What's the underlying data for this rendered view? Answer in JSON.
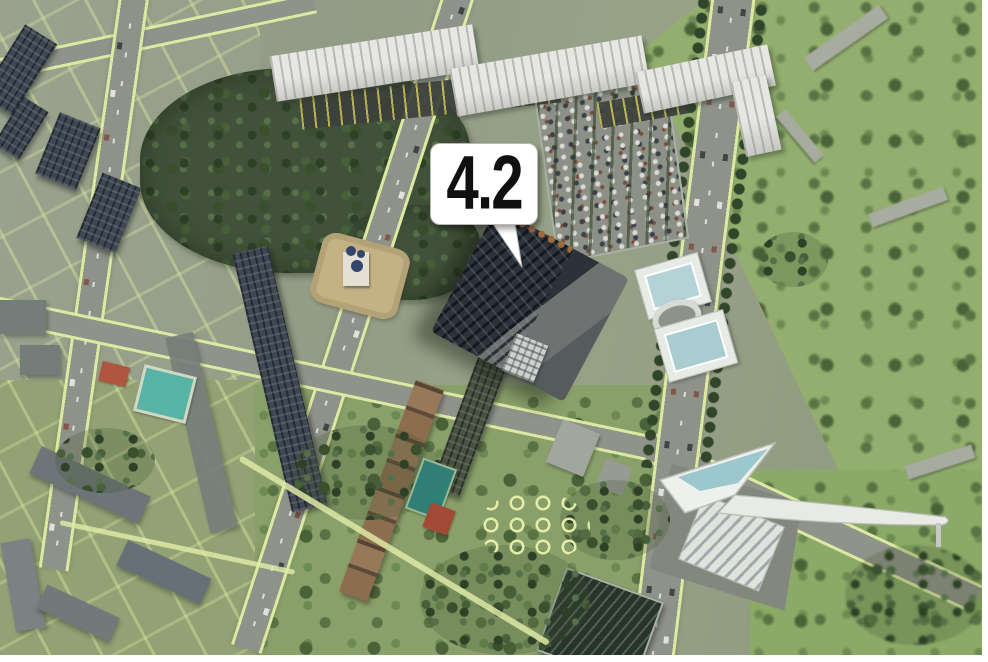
{
  "marker": {
    "label": "4.2"
  },
  "scene": {
    "kind": "aerial-3d-district-render",
    "regions": [
      "forest-park",
      "right-meadow",
      "residential-towers",
      "white-apartment-slabs",
      "parking-lot",
      "tree-lined-avenue",
      "church-plaza",
      "glass-pavilions",
      "highlighted-building-4-2",
      "sail-canopy-structure",
      "sports-courts",
      "playground"
    ]
  },
  "palette": {
    "ground": "#939b86",
    "forest": "#42523a",
    "meadow": "#93ae6e",
    "road": "#8f9289",
    "road_edge": "#dce9a2",
    "white_building": "#e6e6e2",
    "dark_building": "#3f4752",
    "highlight_building": "#2c323a",
    "brown_row": "#8c6d4e",
    "pool_teal": "#57b3a6",
    "court_red": "#b05540",
    "glass_roof": "#b4d3d6",
    "sail_white": "#eef0ec",
    "marker_bg": "#ffffff",
    "marker_text": "#101010"
  }
}
